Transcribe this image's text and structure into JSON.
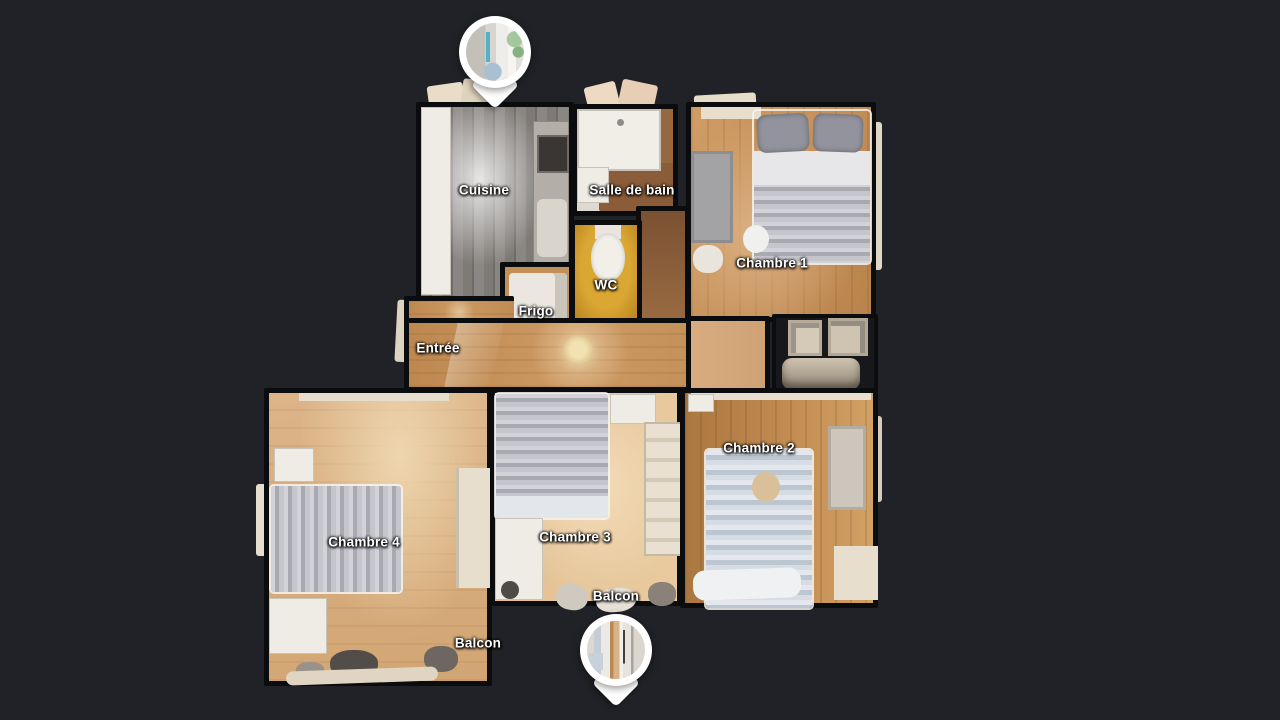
{
  "scene": {
    "view_type": "3d-floorplan-top-view",
    "background_color": "#202227",
    "wall_color": "#0b0c0e",
    "label_text_color": "#ffffff"
  },
  "labels": {
    "cuisine": "Cuisine",
    "salle_de_bain": "Salle de bain",
    "wc": "WC",
    "frigo": "Frigo",
    "entree": "Entrée",
    "chambre_1": "Chambre 1",
    "chambre_2": "Chambre 2",
    "chambre_3": "Chambre 3",
    "chambre_4": "Chambre 4",
    "balcon_a": "Balcon",
    "balcon_b": "Balcon"
  },
  "markers": {
    "top": {
      "icon": "panorama-pin-icon",
      "shape": "teardrop",
      "color": "#ffffff"
    },
    "bottom": {
      "icon": "panorama-pin-icon",
      "shape": "teardrop",
      "color": "#ffffff"
    }
  },
  "palette": {
    "wood_light": "#e9cb9f",
    "wood_medium": "#cd9a63",
    "wood_dark": "#aa7740",
    "kitchen_floor_gray": "#7e7a76",
    "wc_floor_yellow": "#dba733",
    "bathroom_floor_brown": "#8a5c39",
    "bedding_gray": "#a9a9b2",
    "furniture_cream": "#e7decd"
  }
}
